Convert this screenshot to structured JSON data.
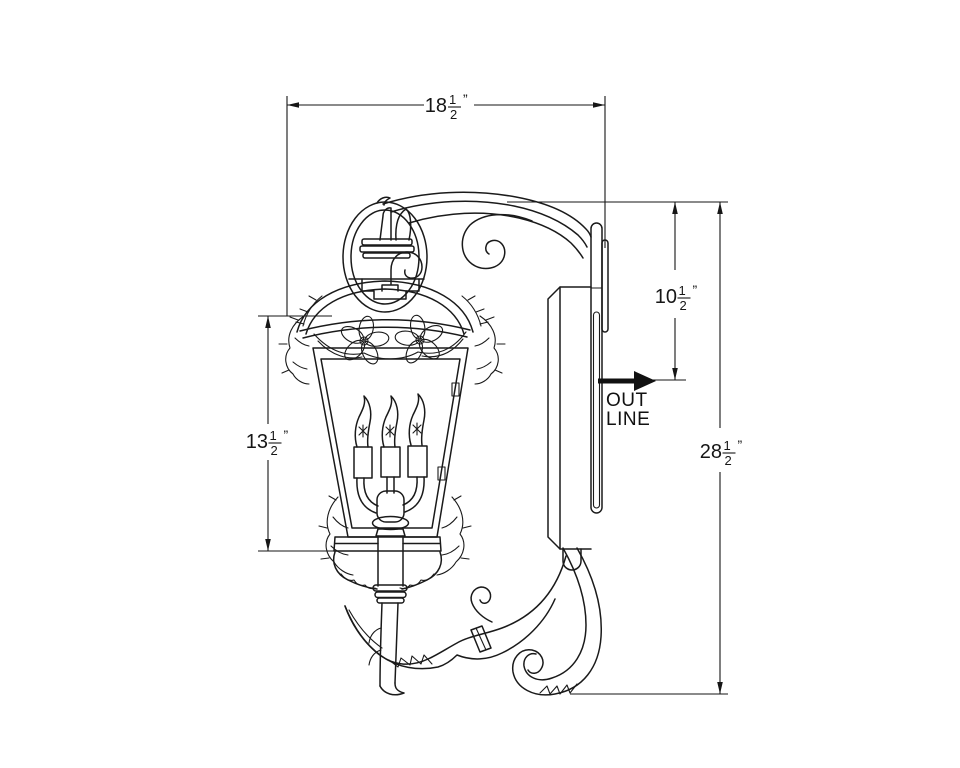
{
  "canvas": {
    "width": 960,
    "height": 768
  },
  "colors": {
    "ink": "#161616",
    "paper": "#ffffff"
  },
  "dimensions": {
    "overall_width": {
      "whole": "18",
      "numerator": "1",
      "denominator": "2",
      "unit_mark": "”"
    },
    "arm_drop": {
      "whole": "10",
      "numerator": "1",
      "denominator": "2",
      "unit_mark": "”"
    },
    "body_height": {
      "whole": "13",
      "numerator": "1",
      "denominator": "2",
      "unit_mark": "”"
    },
    "overall_height": {
      "whole": "28",
      "numerator": "1",
      "denominator": "2",
      "unit_mark": "”"
    }
  },
  "annotations": {
    "outlet_label_line1": "OUT",
    "outlet_label_line2": "LINE"
  }
}
